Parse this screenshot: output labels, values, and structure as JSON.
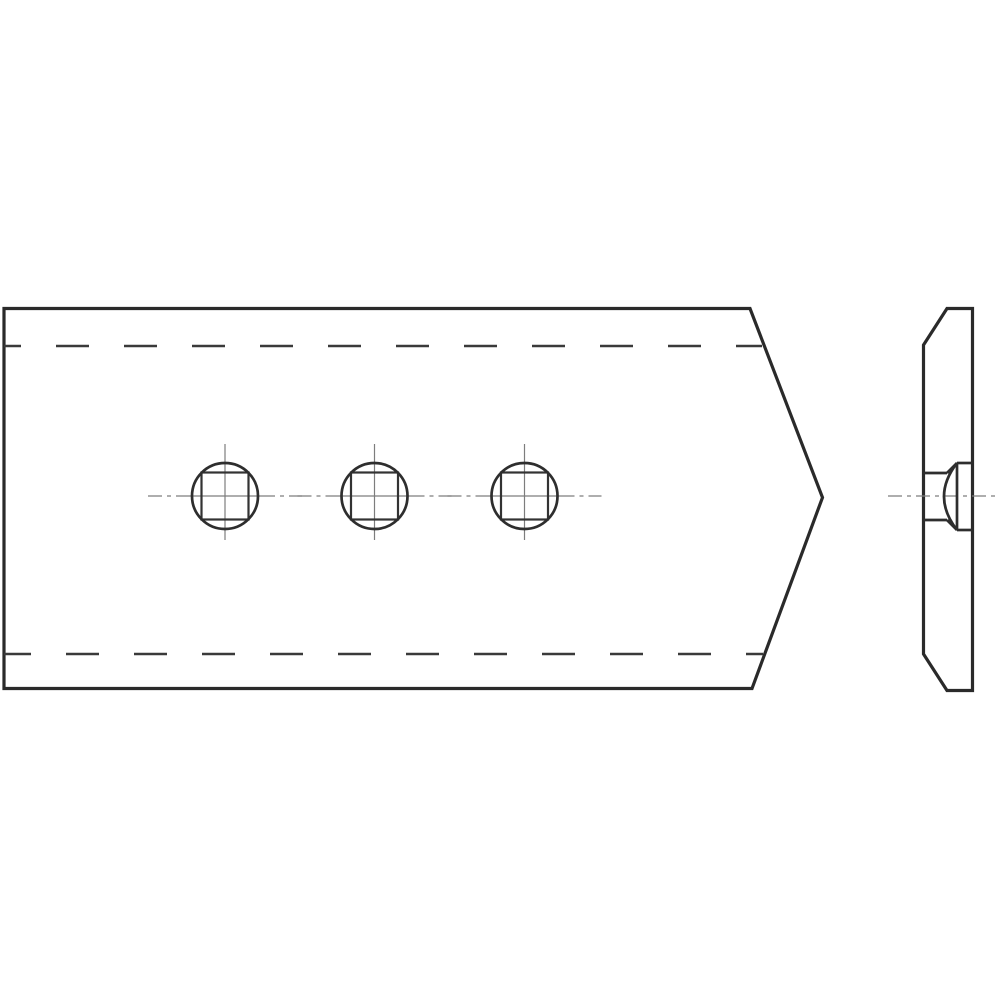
{
  "canvas": {
    "width": 1000,
    "height": 1000,
    "background": "#ffffff"
  },
  "line_styles": {
    "visible_outline": {
      "color": "#2a2a2a",
      "width": 3.2
    },
    "visible_detail": {
      "color": "#2e2e2e",
      "width": 2.7
    },
    "square_detail": {
      "color": "#333333",
      "width": 2.2
    },
    "hidden_edge": {
      "color": "#3a3a3a",
      "width": 2.4,
      "dash": "33 35"
    },
    "centerline": {
      "color": "#7d7d7d",
      "width": 1.2,
      "dash": "14 5 4 5"
    }
  },
  "front_view": {
    "outline_points": "4,308.5 750,308.5 822.5,497.5 752,688.5 4,688.5",
    "hidden_lines": [
      {
        "name": "top-hidden-edge",
        "x1": 4,
        "x2": 762,
        "y": 346,
        "dash_offset": 16
      },
      {
        "name": "bottom-hidden-edge",
        "x1": 4,
        "x2": 763,
        "y": 654,
        "dash_offset": 6
      }
    ],
    "holes": {
      "cy": 496,
      "circle_radius": 33,
      "square_size": 47,
      "centers_x": [
        225,
        374.5,
        524.5
      ],
      "vertical_centerline": {
        "y1": 444,
        "y2": 540
      },
      "horizontal_centerline": {
        "outer_extent": 77,
        "solid_extent": 36
      }
    }
  },
  "side_view": {
    "outline_points": "923.5,345 947,308.5 972.5,308.5 972.5,690.5 947,690.5 923.5,654",
    "bolt_lines": [
      {
        "name": "bolt-neck-top-line",
        "x1": 923.5,
        "y1": 473,
        "x2": 947,
        "y2": 473
      },
      {
        "name": "bolt-neck-bottom-line",
        "x1": 923.5,
        "y1": 520,
        "x2": 947,
        "y2": 520
      },
      {
        "name": "bolt-cone-top-line",
        "x1": 947,
        "y1": 473,
        "x2": 957,
        "y2": 463
      },
      {
        "name": "bolt-cone-bottom-line",
        "x1": 947,
        "y1": 520,
        "x2": 957,
        "y2": 530
      },
      {
        "name": "bolt-head-seat-line",
        "x1": 957,
        "y1": 463,
        "x2": 957,
        "y2": 530
      },
      {
        "name": "bolt-head-top-line",
        "x1": 957,
        "y1": 463,
        "x2": 972.5,
        "y2": 463
      },
      {
        "name": "bolt-head-bottom-line",
        "x1": 957,
        "y1": 530,
        "x2": 972.5,
        "y2": 530
      }
    ],
    "bolt_head_dome_path": "M 957 463 Q 931 496.5 957 530",
    "centerline": {
      "x1": 888,
      "x2": 1000,
      "y": 496
    }
  }
}
